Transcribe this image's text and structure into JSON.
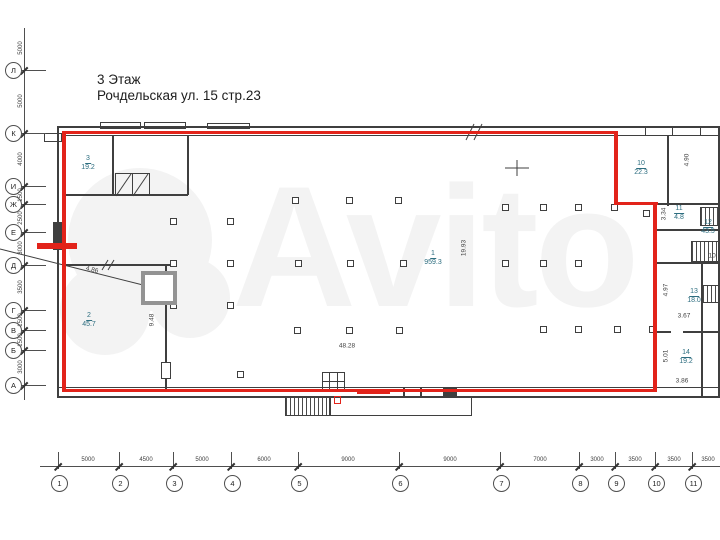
{
  "title": {
    "line1": "3 Этаж",
    "line2": "Рочдельская ул. 15 стр.23"
  },
  "watermark": {
    "text": "Avito"
  },
  "colors": {
    "red": "#e2231a",
    "wall": "#3f3f3f",
    "axis": "#4f4f4f",
    "room_label": "#2e6e80",
    "dim": "#3f3f3f",
    "watermark": "#f3f3f3"
  },
  "rooms": [
    {
      "number": "3",
      "area": "19.2",
      "x": 88,
      "y": 163
    },
    {
      "number": "2",
      "area": "45.7",
      "x": 89,
      "y": 320
    },
    {
      "number": "1",
      "area": "959.3",
      "x": 433,
      "y": 258
    },
    {
      "number": "10",
      "area": "22.3",
      "x": 641,
      "y": 168
    },
    {
      "number": "11",
      "area": "4.8",
      "x": 679,
      "y": 213
    },
    {
      "number": "12",
      "area": "43.5",
      "x": 708,
      "y": 227
    },
    {
      "number": "13",
      "area": "18.0",
      "x": 694,
      "y": 296
    },
    {
      "number": "14",
      "area": "19.2",
      "x": 686,
      "y": 357
    }
  ],
  "dimensions": [
    {
      "text": "19.93",
      "x": 464,
      "y": 248,
      "rot": -90
    },
    {
      "text": "48.28",
      "x": 347,
      "y": 346,
      "rot": 0
    },
    {
      "text": "9.48",
      "x": 152,
      "y": 320,
      "rot": -90
    },
    {
      "text": "4.86",
      "x": 92,
      "y": 270,
      "rot": 14
    },
    {
      "text": "4.90",
      "x": 687,
      "y": 160,
      "rot": -90
    },
    {
      "text": "3.34",
      "x": 664,
      "y": 214,
      "rot": -90
    },
    {
      "text": "3.67",
      "x": 684,
      "y": 316,
      "rot": 0
    },
    {
      "text": "4.97",
      "x": 666,
      "y": 290,
      "rot": -90
    },
    {
      "text": "3.86",
      "x": 682,
      "y": 381,
      "rot": 0
    },
    {
      "text": "5.01",
      "x": 666,
      "y": 356,
      "rot": -90
    },
    {
      "text": "10.",
      "x": 713,
      "y": 256,
      "rot": 0
    }
  ],
  "axis_left": {
    "items": [
      {
        "label": "Л",
        "y": 70
      },
      {
        "label": "К",
        "y": 133
      },
      {
        "label": "И",
        "y": 186
      },
      {
        "label": "Ж",
        "y": 204
      },
      {
        "label": "Е",
        "y": 232
      },
      {
        "label": "Д",
        "y": 265
      },
      {
        "label": "Г",
        "y": 310
      },
      {
        "label": "В",
        "y": 330
      },
      {
        "label": "Б",
        "y": 350
      },
      {
        "label": "А",
        "y": 385
      }
    ],
    "dims": [
      {
        "text": "5000",
        "y": 48
      },
      {
        "text": "5000",
        "y": 101
      },
      {
        "text": "4000",
        "y": 159
      },
      {
        "text": "1500",
        "y": 195
      },
      {
        "text": "2500",
        "y": 218
      },
      {
        "text": "3000",
        "y": 248
      },
      {
        "text": "3500",
        "y": 287
      },
      {
        "text": "1500",
        "y": 320
      },
      {
        "text": "1500",
        "y": 340
      },
      {
        "text": "3000",
        "y": 367
      }
    ]
  },
  "axis_bottom": {
    "items": [
      {
        "label": "1",
        "x": 58
      },
      {
        "label": "2",
        "x": 119
      },
      {
        "label": "3",
        "x": 173
      },
      {
        "label": "4",
        "x": 231
      },
      {
        "label": "5",
        "x": 298
      },
      {
        "label": "6",
        "x": 399
      },
      {
        "label": "7",
        "x": 500
      },
      {
        "label": "8",
        "x": 579
      },
      {
        "label": "9",
        "x": 615
      },
      {
        "label": "10",
        "x": 655
      },
      {
        "label": "11",
        "x": 692
      }
    ],
    "dims": [
      {
        "text": "5000",
        "x": 88
      },
      {
        "text": "4500",
        "x": 146
      },
      {
        "text": "5000",
        "x": 202
      },
      {
        "text": "6000",
        "x": 264
      },
      {
        "text": "9000",
        "x": 348
      },
      {
        "text": "9000",
        "x": 450
      },
      {
        "text": "7000",
        "x": 540
      },
      {
        "text": "3000",
        "x": 597
      },
      {
        "text": "3500",
        "x": 635
      },
      {
        "text": "3500",
        "x": 674
      },
      {
        "text": "3500",
        "x": 708
      }
    ]
  },
  "geometry": {
    "red": [
      {
        "x": 62,
        "y": 131,
        "w": 556,
        "h": 3
      },
      {
        "x": 614,
        "y": 131,
        "w": 4,
        "h": 74
      },
      {
        "x": 614,
        "y": 202,
        "w": 44,
        "h": 3
      },
      {
        "x": 653,
        "y": 202,
        "w": 4,
        "h": 190
      },
      {
        "x": 62,
        "y": 389,
        "w": 595,
        "h": 3
      },
      {
        "x": 62,
        "y": 131,
        "w": 4,
        "h": 261
      },
      {
        "x": 37,
        "y": 243,
        "w": 40,
        "h": 6
      },
      {
        "x": 357,
        "y": 390,
        "w": 33,
        "h": 4
      },
      {
        "x": 334,
        "y": 396,
        "w": 7,
        "h": 8,
        "outline": true
      }
    ],
    "walls": [
      {
        "x": 57,
        "y": 126,
        "w": 663,
        "h": 2
      },
      {
        "x": 62,
        "y": 135,
        "w": 656,
        "h": 1
      },
      {
        "x": 57,
        "y": 126,
        "w": 2,
        "h": 272
      },
      {
        "x": 718,
        "y": 126,
        "w": 2,
        "h": 272
      },
      {
        "x": 57,
        "y": 387,
        "w": 663,
        "h": 1
      },
      {
        "x": 57,
        "y": 396,
        "w": 663,
        "h": 2
      },
      {
        "x": 53,
        "y": 222,
        "w": 9,
        "h": 28
      },
      {
        "x": 112,
        "y": 136,
        "w": 2,
        "h": 59
      },
      {
        "x": 187,
        "y": 136,
        "w": 2,
        "h": 59
      },
      {
        "x": 62,
        "y": 194,
        "w": 126,
        "h": 2
      },
      {
        "x": 667,
        "y": 136,
        "w": 2,
        "h": 70
      },
      {
        "x": 617,
        "y": 203,
        "w": 103,
        "h": 2
      },
      {
        "x": 657,
        "y": 229,
        "w": 63,
        "h": 2
      },
      {
        "x": 657,
        "y": 262,
        "w": 63,
        "h": 2
      },
      {
        "x": 657,
        "y": 331,
        "w": 14,
        "h": 2
      },
      {
        "x": 683,
        "y": 331,
        "w": 37,
        "h": 2
      },
      {
        "x": 701,
        "y": 262,
        "w": 2,
        "h": 134
      },
      {
        "x": 62,
        "y": 264,
        "w": 114,
        "h": 2
      },
      {
        "x": 165,
        "y": 264,
        "w": 2,
        "h": 99
      },
      {
        "x": 165,
        "y": 378,
        "w": 2,
        "h": 12
      },
      {
        "x": 403,
        "y": 388,
        "w": 2,
        "h": 8
      },
      {
        "x": 420,
        "y": 388,
        "w": 2,
        "h": 8
      },
      {
        "x": 443,
        "y": 388,
        "w": 14,
        "h": 8
      },
      {
        "x": 645,
        "y": 127,
        "w": 1,
        "h": 9
      },
      {
        "x": 672,
        "y": 127,
        "w": 1,
        "h": 9
      },
      {
        "x": 700,
        "y": 127,
        "w": 1,
        "h": 9
      },
      {
        "x": 329,
        "y": 372,
        "w": 1,
        "h": 20
      },
      {
        "x": 337,
        "y": 372,
        "w": 1,
        "h": 20
      },
      {
        "x": 322,
        "y": 381,
        "w": 23,
        "h": 1
      }
    ],
    "outlines": [
      {
        "x": 100,
        "y": 122,
        "w": 41,
        "h": 7
      },
      {
        "x": 144,
        "y": 122,
        "w": 42,
        "h": 7
      },
      {
        "x": 207,
        "y": 123,
        "w": 43,
        "h": 6
      },
      {
        "x": 330,
        "y": 396,
        "w": 142,
        "h": 20
      },
      {
        "x": 322,
        "y": 372,
        "w": 23,
        "h": 20
      },
      {
        "x": 161,
        "y": 362,
        "w": 10,
        "h": 17
      },
      {
        "x": 44,
        "y": 133,
        "w": 18,
        "h": 9
      },
      {
        "x": 115,
        "y": 173,
        "w": 18,
        "h": 23
      },
      {
        "x": 132,
        "y": 173,
        "w": 18,
        "h": 23
      }
    ],
    "hatches": [
      {
        "x": 285,
        "y": 397,
        "w": 45,
        "h": 19
      },
      {
        "x": 700,
        "y": 207,
        "w": 20,
        "h": 19
      },
      {
        "x": 691,
        "y": 241,
        "w": 29,
        "h": 21
      },
      {
        "x": 702,
        "y": 285,
        "w": 18,
        "h": 18
      }
    ],
    "columns": [
      [
        295,
        200
      ],
      [
        349,
        200
      ],
      [
        398,
        200
      ],
      [
        505,
        207
      ],
      [
        543,
        207
      ],
      [
        578,
        207
      ],
      [
        614,
        207
      ],
      [
        173,
        221
      ],
      [
        230,
        221
      ],
      [
        173,
        263
      ],
      [
        230,
        263
      ],
      [
        298,
        263
      ],
      [
        350,
        263
      ],
      [
        403,
        263
      ],
      [
        505,
        263
      ],
      [
        543,
        263
      ],
      [
        578,
        263
      ],
      [
        646,
        213
      ],
      [
        173,
        305
      ],
      [
        230,
        305
      ],
      [
        297,
        330
      ],
      [
        349,
        330
      ],
      [
        399,
        330
      ],
      [
        543,
        329
      ],
      [
        578,
        329
      ],
      [
        617,
        329
      ],
      [
        652,
        329
      ],
      [
        240,
        374
      ]
    ],
    "lines": [
      [
        0,
        249,
        143,
        285,
        1
      ],
      [
        145,
        275,
        173,
        301,
        1.2
      ],
      [
        145,
        301,
        173,
        275,
        1.2
      ],
      [
        116,
        196,
        131,
        174,
        1
      ],
      [
        133,
        196,
        148,
        174,
        1
      ],
      [
        466,
        140,
        474,
        124,
        1
      ],
      [
        474,
        140,
        482,
        124,
        1
      ],
      [
        505,
        168,
        529,
        168,
        1
      ],
      [
        517,
        160,
        517,
        176,
        1
      ],
      [
        102,
        270,
        108,
        260,
        1
      ],
      [
        108,
        270,
        114,
        260,
        1
      ]
    ],
    "elevator": {
      "x": 141,
      "y": 271,
      "w": 36,
      "h": 34
    }
  }
}
